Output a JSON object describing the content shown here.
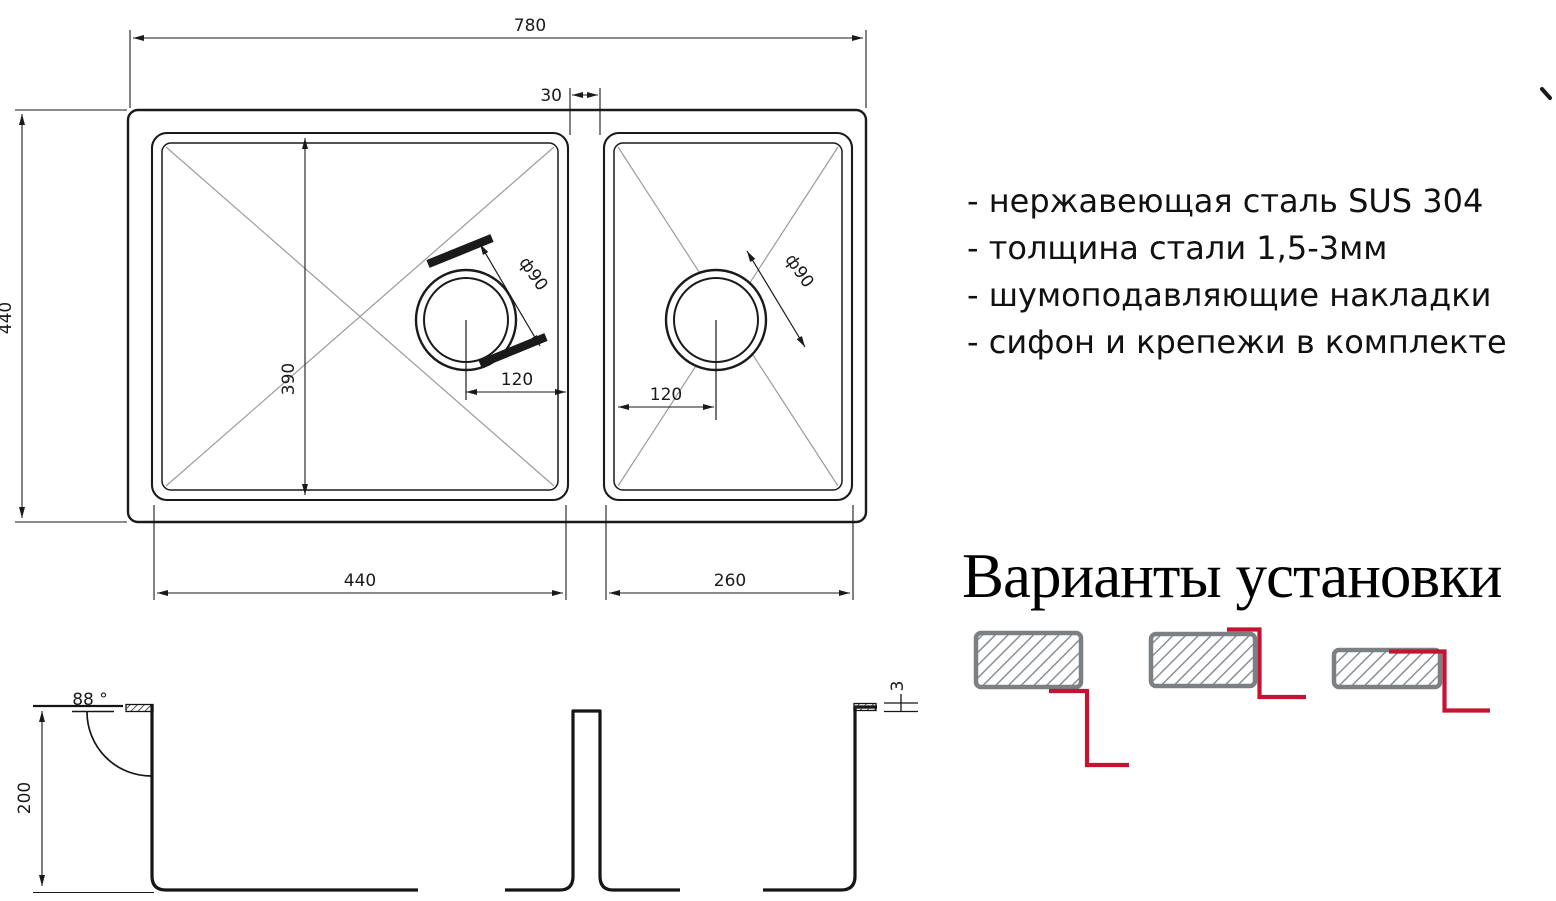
{
  "drawing": {
    "dims": {
      "overall_width": "780",
      "overall_depth": "440",
      "gap": "30",
      "bowl_inner_length": "390",
      "left_bowl_width": "440",
      "right_bowl_width": "260",
      "left_drain_offset": "120",
      "right_drain_offset": "120",
      "left_drain_dia": "ф90",
      "right_drain_dia": "ф90",
      "bowl_depth": "200",
      "wall_angle": "88 °",
      "rim_thickness": "3"
    }
  },
  "specs": {
    "items": [
      "- нержавеющая сталь SUS 304",
      "- толщина стали 1,5-3мм",
      "- шумоподавляющие накладки",
      "- сифон и крепежи в комплекте"
    ]
  },
  "installation": {
    "heading": "Варианты установки"
  },
  "colors": {
    "line": "#1a1a1a",
    "diagonal_gray": "#9b9b9b",
    "mount_border_gray": "#7b8085",
    "mount_hatch_gray": "#8b9096",
    "mount_red": "#c41431"
  }
}
